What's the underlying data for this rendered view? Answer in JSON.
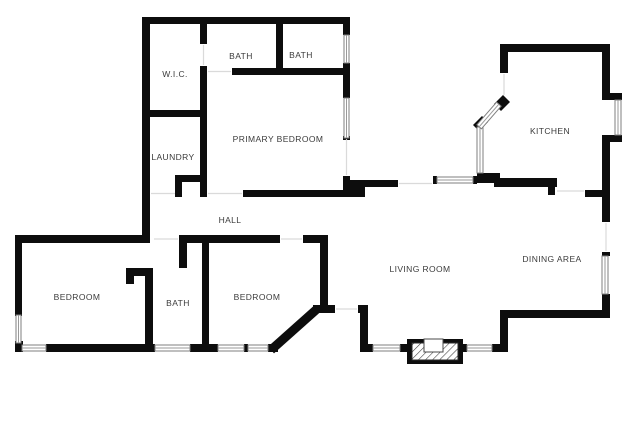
{
  "page": {
    "title": "Floor Plan",
    "background": "#ffffff"
  },
  "colors": {
    "wall": "#0d0d0d",
    "window_stroke": "#7f7f7f",
    "window_fill": "#ffffff",
    "door_opening": "#d6d6d6",
    "label": "#3b3b3b"
  },
  "rooms": [
    {
      "id": "wic",
      "label": "W.I.C."
    },
    {
      "id": "bath-top-left",
      "label": "BATH"
    },
    {
      "id": "bath-top-right",
      "label": "BATH"
    },
    {
      "id": "primary-bedroom",
      "label": "PRIMARY BEDROOM"
    },
    {
      "id": "laundry",
      "label": "LAUNDRY"
    },
    {
      "id": "kitchen",
      "label": "KITCHEN"
    },
    {
      "id": "hall",
      "label": "HALL"
    },
    {
      "id": "bedroom-left",
      "label": "BEDROOM"
    },
    {
      "id": "bath-lower",
      "label": "BATH"
    },
    {
      "id": "bedroom-right",
      "label": "BEDROOM"
    },
    {
      "id": "living-room",
      "label": "LIVING ROOM"
    },
    {
      "id": "dining-area",
      "label": "DINING AREA"
    }
  ],
  "features": {
    "fireplace": "fireplace",
    "bay_window_wall": "angled bay wall",
    "windows": "double-line window symbols",
    "door_openings": "wall gaps"
  }
}
